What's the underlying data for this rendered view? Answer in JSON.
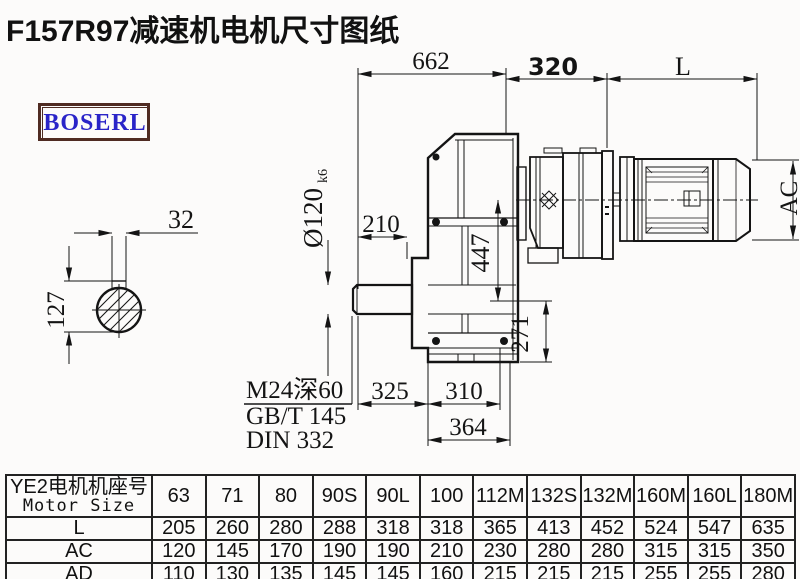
{
  "page": {
    "title": "F157R97减速机电机尺寸图纸",
    "brand": "BOSERL"
  },
  "colors": {
    "brand_text": "#2a24c8",
    "logo_border": "#4f2b22",
    "line": "#141414"
  },
  "drawing": {
    "dims": {
      "total_length": "662",
      "input_length": "320",
      "motor_length": "L",
      "motor_od": "AC",
      "key_width": "32",
      "key_height": "127",
      "shaft_ext": "210",
      "shaft_dia": "Ø120",
      "shaft_dia_tol": "k6",
      "axis_to_input": "447",
      "axis_to_bottom": "271",
      "bottom_left": "325",
      "bottom_mid": "310",
      "bottom_width": "364"
    },
    "notes": {
      "tap_hole": "M24深60",
      "standard_1": "GB/T 145",
      "standard_2": "DIN 332"
    }
  },
  "table": {
    "header": {
      "line1": "YE2电机机座号",
      "line2": "Motor Size"
    },
    "columns": [
      "63",
      "71",
      "80",
      "90S",
      "90L",
      "100",
      "112M",
      "132S",
      "132M",
      "160M",
      "160L",
      "180M"
    ],
    "rows": [
      {
        "label": "L",
        "values": [
          "205",
          "260",
          "280",
          "288",
          "318",
          "318",
          "365",
          "413",
          "452",
          "524",
          "547",
          "635"
        ]
      },
      {
        "label": "AC",
        "values": [
          "120",
          "145",
          "170",
          "190",
          "190",
          "210",
          "230",
          "280",
          "280",
          "315",
          "315",
          "350"
        ]
      },
      {
        "label": "AD",
        "values": [
          "110",
          "130",
          "135",
          "145",
          "145",
          "160",
          "215",
          "215",
          "215",
          "255",
          "255",
          "280"
        ]
      }
    ]
  }
}
